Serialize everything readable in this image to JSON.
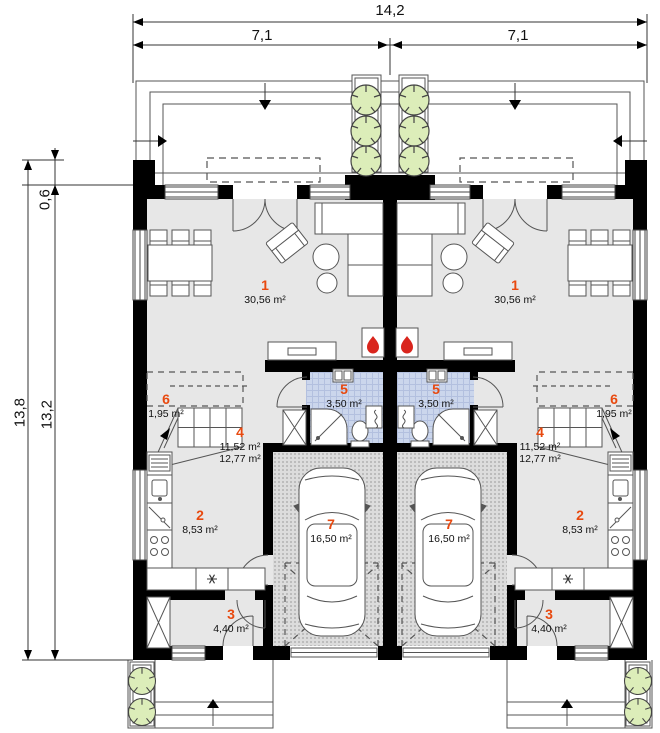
{
  "dimensions": {
    "total_width": "14,2",
    "unit_width_left": "7,1",
    "unit_width_right": "7,1",
    "depth_outer": "13,8",
    "depth_inner": "13,2",
    "terrace_offset": "0,6"
  },
  "units": {
    "left": {
      "living": {
        "no": "1",
        "area": "30,56 m²"
      },
      "kitchen": {
        "no": "2",
        "area": "8,53 m²"
      },
      "entry": {
        "no": "3",
        "area": "4,40 m²"
      },
      "hall": {
        "no": "4",
        "area_floor": "11,52 m²",
        "area_total": "12,77 m²"
      },
      "bathroom": {
        "no": "5",
        "area": "3,50 m²"
      },
      "storage": {
        "no": "6",
        "area": "1,95 m²"
      },
      "garage": {
        "no": "7",
        "area": "16,50 m²"
      }
    },
    "right": {
      "living": {
        "no": "1",
        "area": "30,56 m²"
      },
      "kitchen": {
        "no": "2",
        "area": "8,53 m²"
      },
      "entry": {
        "no": "3",
        "area": "4,40 m²"
      },
      "hall": {
        "no": "4",
        "area_floor": "11,52 m²",
        "area_total": "12,77 m²"
      },
      "bathroom": {
        "no": "5",
        "area": "3,50 m²"
      },
      "storage": {
        "no": "6",
        "area": "1,95 m²"
      },
      "garage": {
        "no": "7",
        "area": "16,50 m²"
      }
    }
  },
  "colors": {
    "wall": "#000000",
    "floor": "#e7e7e7",
    "bathroom_tile": "#cbd6ec",
    "garage_floor": "#dcdcdc",
    "tree": "#dcedb9",
    "room_number_accent": "#e8490f",
    "flame": "#d9251d"
  }
}
